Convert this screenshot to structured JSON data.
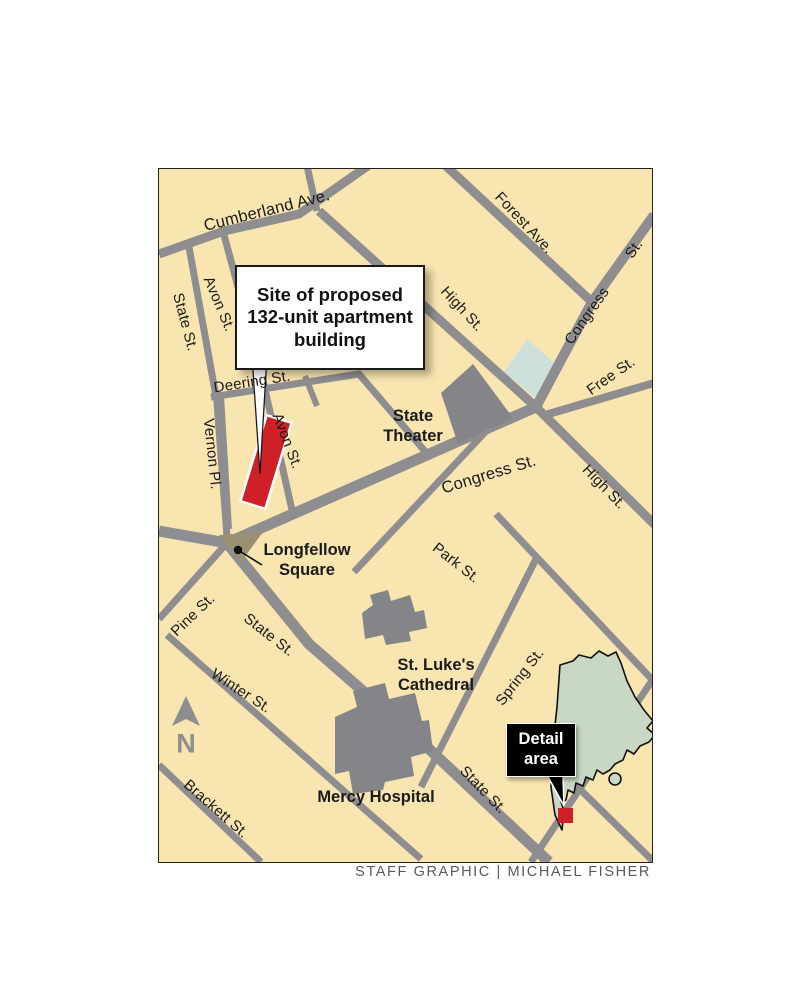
{
  "map": {
    "streets": {
      "cumberland": "Cumberland Ave.",
      "forest": "Forest Ave.",
      "congress_top": "Congress",
      "congress_top_st": "St.",
      "high_upper": "High St.",
      "high_lower": "High St.",
      "free": "Free St.",
      "congress_main": "Congress St.",
      "park": "Park St.",
      "deering": "Deering St.",
      "vernon": "Vernon Pl.",
      "avon_upper": "Avon St.",
      "avon_lower": "Avon St.",
      "state_left": "State St.",
      "state_main": "State St.",
      "state_lower": "State St.",
      "pine": "Pine St.",
      "winter": "Winter St.",
      "brackett": "Brackett St.",
      "spring": "Spring St."
    },
    "landmarks": {
      "state_theater": [
        "State",
        "Theater"
      ],
      "longfellow": [
        "Longfellow",
        "Square"
      ],
      "st_lukes": [
        "St. Luke's",
        "Cathedral"
      ],
      "mercy": [
        "Mercy Hospital"
      ]
    },
    "callout": {
      "line1": "Site of proposed",
      "line2": "132-unit apartment",
      "line3": "building"
    },
    "inset": {
      "line1": "Detail",
      "line2": "area"
    },
    "north_label": "N",
    "credit": "STAFF GRAPHIC | MICHAEL FISHER",
    "colors": {
      "map_bg": "#F9E5B0",
      "road": "#8E8E91",
      "building": "#838589",
      "site_red": "#D02027",
      "inset_green": "#C9D8C5",
      "pond_blue": "#CEE0DB",
      "square_tan": "#9A9173",
      "ink": "#1A1A1A",
      "credit_gray": "#595A5C"
    }
  }
}
